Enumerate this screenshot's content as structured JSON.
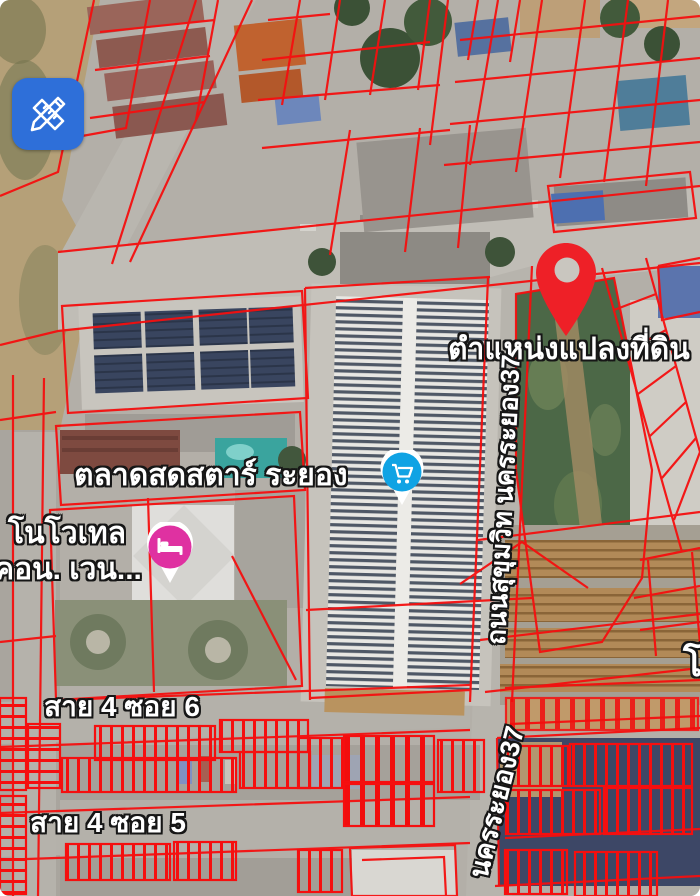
{
  "app": {
    "view": "satellite-map-with-cadastral-overlay",
    "edit_button": {
      "icon": "ruler-pencil-icon"
    }
  },
  "labels": {
    "parcel_pin": "ตำแหน่งแปลงที่ดิน",
    "market": "ตลาดสดสตาร์ ระยอง",
    "hotel_line1": "โนโวเทล",
    "hotel_line2": "คอน. เวน...",
    "street_soi_6": "สาย 4 ซอย 6",
    "street_soi_5": "สาย 4 ซอย 5",
    "road_sukhumvit": "ถนนสุขุมวิท นครระยอง37",
    "road_nakhon_rayong_37": "นครระยอง37",
    "edge_partial": "โ"
  },
  "markers": {
    "parcel_pin_icon": "map-pin-icon",
    "market_icon": "shopping-cart-icon",
    "hotel_icon": "bed-icon"
  },
  "colors": {
    "cadastral_line": "#f50f0f",
    "pin_red": "#ee2027",
    "edit_button_blue": "#2e6fd9",
    "market_marker_blue": "#10a3e4",
    "hotel_marker_pink": "#df31a1"
  }
}
